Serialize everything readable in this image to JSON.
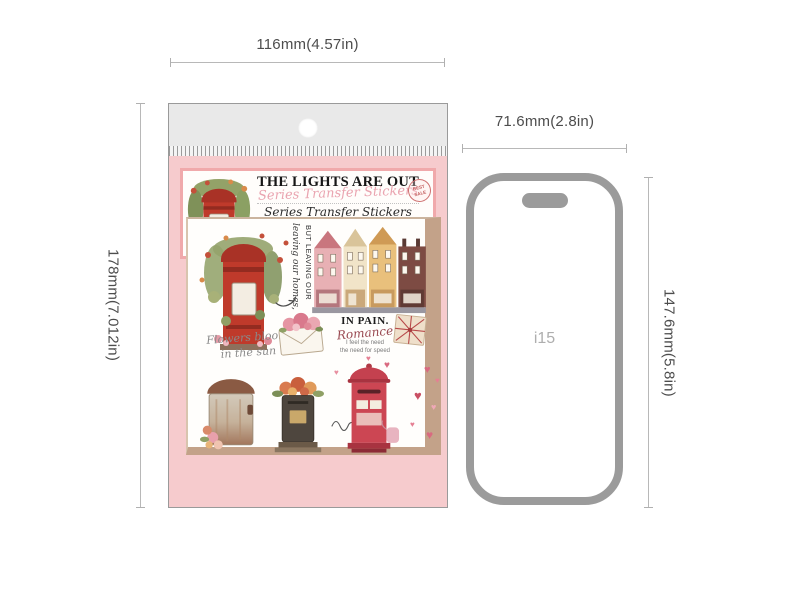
{
  "dimensions": {
    "package_width": "116mm(4.57in)",
    "package_height": "178mm(7.012in)",
    "phone_width": "71.6mm(2.8in)",
    "phone_height": "147.6mm(5.8in)"
  },
  "package": {
    "header": {
      "title": "THE LIGHTS ARE OUT",
      "script_overlay": "Series Transfer Stickers",
      "series_script": "Series Transfer Stickers",
      "self_inking": "SELF-INKING STICKER",
      "badge_top": "BEST",
      "badge_bottom": "SALE"
    },
    "sheet": {
      "vertical_script": "leaving our homes,",
      "vertical_caps": "BUT LEAVING OUR",
      "flowers_line1": "Flowers bloom",
      "flowers_line2": "in the sun",
      "in_pain": "IN PAIN.",
      "romance": "Romance",
      "romance_note1": "I feel the need",
      "romance_note2": "the need for speed"
    }
  },
  "phone": {
    "model_label": "i15"
  },
  "icons": {
    "heart": "♥"
  },
  "colors": {
    "accent_red": "#bf3a2b",
    "package_pink": "#f6cbcd",
    "card_border_pink": "#f0a9ab",
    "backing_tan": "#c3a289",
    "phone_gray": "#9b9b9b",
    "dimension_line_gray": "#b8b8b8"
  }
}
